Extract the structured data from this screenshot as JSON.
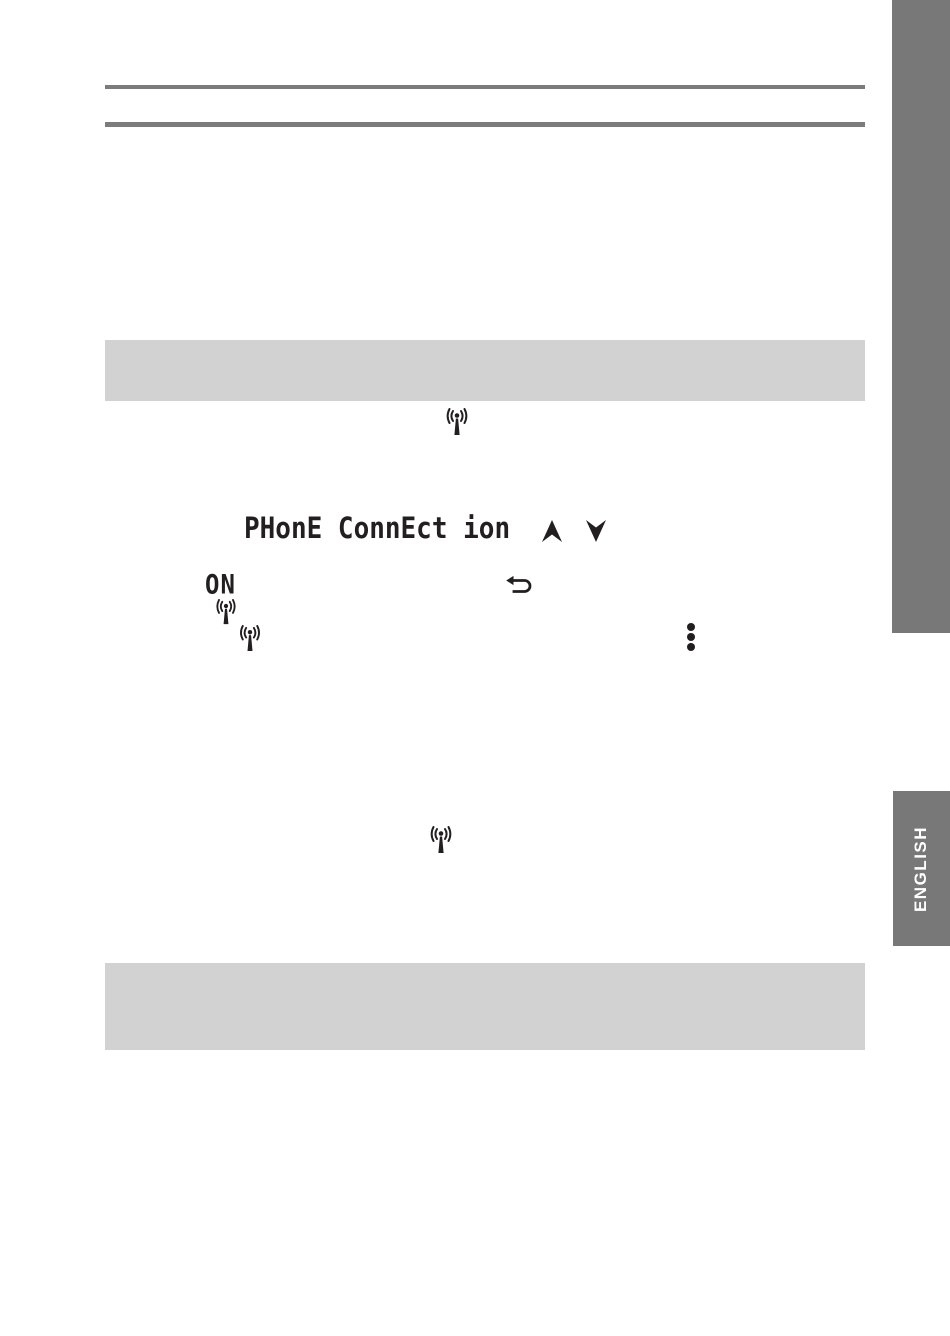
{
  "page": {
    "bg": "#ffffff",
    "ink": "#231f20"
  },
  "header": {
    "rule_color": "#7c7c7c"
  },
  "sidebar": {
    "bar_color": "#787878"
  },
  "language_tab": {
    "label": "ENGLISH",
    "bg": "#787878",
    "text_color": "#ffffff"
  },
  "highlight_bands": {
    "color": "#d2d2d2",
    "count": 2
  },
  "lcd_display": {
    "menu_text": "PHonE ConnEct ion",
    "status_text": "ON"
  },
  "icons": {
    "broadcast": "broadcast-antenna",
    "up_arrow": "up-arrow",
    "down_arrow": "down-arrow",
    "return_arrow": "return-back-arrow",
    "kebab": "vertical-ellipsis-menu"
  }
}
